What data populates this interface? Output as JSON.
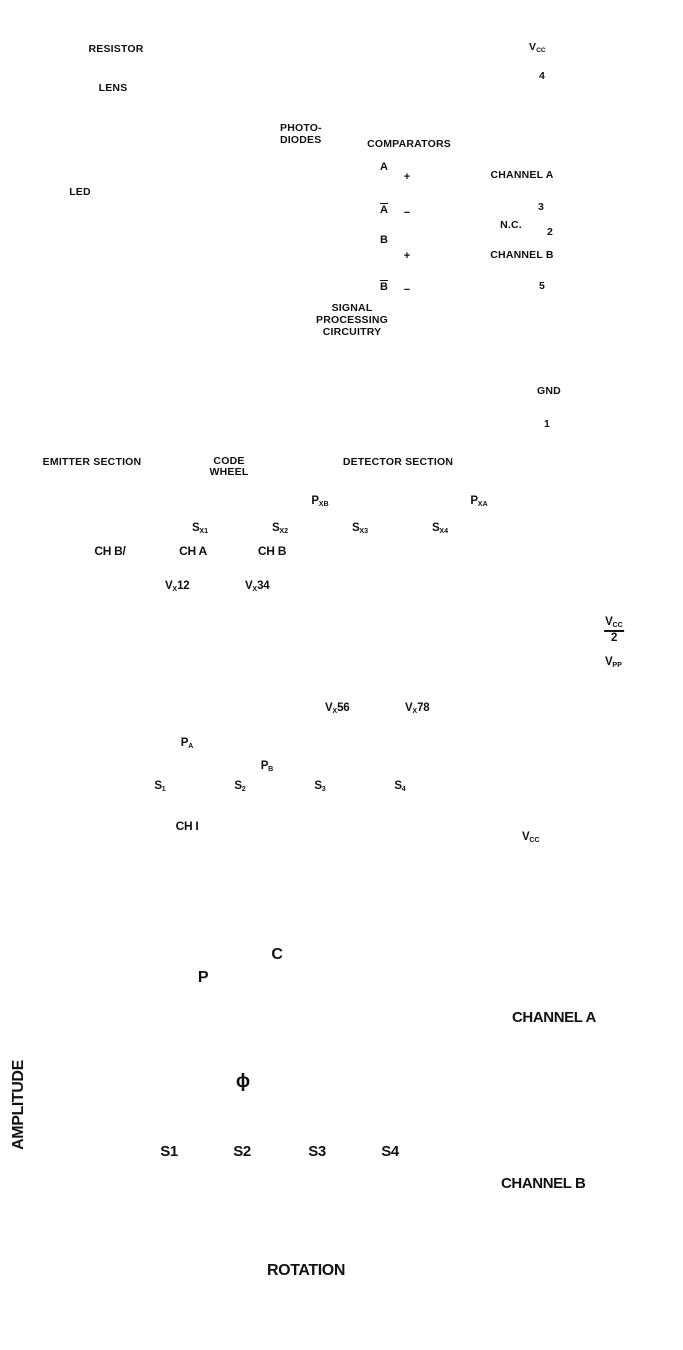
{
  "top": {
    "resistor": "RESISTOR",
    "lens": "LENS",
    "led": "LED",
    "photodiodes_line1": "PHOTO-",
    "photodiodes_line2": "DIODES",
    "comparators": "COMPARATORS",
    "sig_a": "A",
    "sig_a_bar": "A",
    "sig_b": "B",
    "sig_b_bar": "B",
    "plus": "+",
    "minus": "−",
    "spc_line1": "SIGNAL",
    "spc_line2": "PROCESSING",
    "spc_line3": "CIRCUITRY",
    "pins": {
      "vcc": {
        "t": "V",
        "s": "CC"
      },
      "vcc_num": "4",
      "cha": "CHANNEL A",
      "cha_num": "3",
      "nc": "N.C.",
      "nc_num": "2",
      "chb": "CHANNEL B",
      "chb_num": "5",
      "gnd": "GND",
      "gnd_num": "1"
    },
    "emitter_section": "EMITTER SECTION",
    "code_wheel_line1": "CODE",
    "code_wheel_line2": "WHEEL",
    "detector_section": "DETECTOR SECTION"
  },
  "middle": {
    "pxb": {
      "t": "P",
      "s": "XB"
    },
    "pxa": {
      "t": "P",
      "s": "XA"
    },
    "sx1": {
      "t": "S",
      "s": "X1"
    },
    "sx2": {
      "t": "S",
      "s": "X2"
    },
    "sx3": {
      "t": "S",
      "s": "X3"
    },
    "sx4": {
      "t": "S",
      "s": "X4"
    },
    "ch_b_inv": "CH B/",
    "ch_a": "CH A",
    "ch_b": "CH B",
    "vx12": {
      "t": "V",
      "s": "X",
      "r": "12"
    },
    "vx34": {
      "t": "V",
      "s": "X",
      "r": "34"
    },
    "vx56": {
      "t": "V",
      "s": "X",
      "r": "56"
    },
    "vx78": {
      "t": "V",
      "s": "X",
      "r": "78"
    },
    "vcc_half": {
      "num": "V",
      "num_sub": "CC",
      "den": "2"
    },
    "vpp": {
      "t": "V",
      "s": "PP"
    },
    "pa": {
      "t": "P",
      "s": "A"
    },
    "pb": {
      "t": "P",
      "s": "B"
    },
    "s1": {
      "t": "S",
      "s": "1"
    },
    "s2": {
      "t": "S",
      "s": "2"
    },
    "s3": {
      "t": "S",
      "s": "3"
    },
    "s4": {
      "t": "S",
      "s": "4"
    },
    "chi": "CH I",
    "vcc": {
      "t": "V",
      "s": "CC"
    }
  },
  "bottom": {
    "c": "C",
    "p": "P",
    "phi": "ϕ",
    "s1": "S1",
    "s2": "S2",
    "s3": "S3",
    "s4": "S4",
    "channel_a": "CHANNEL A",
    "channel_b": "CHANNEL B",
    "amplitude": "AMPLITUDE",
    "rotation": "ROTATION"
  }
}
